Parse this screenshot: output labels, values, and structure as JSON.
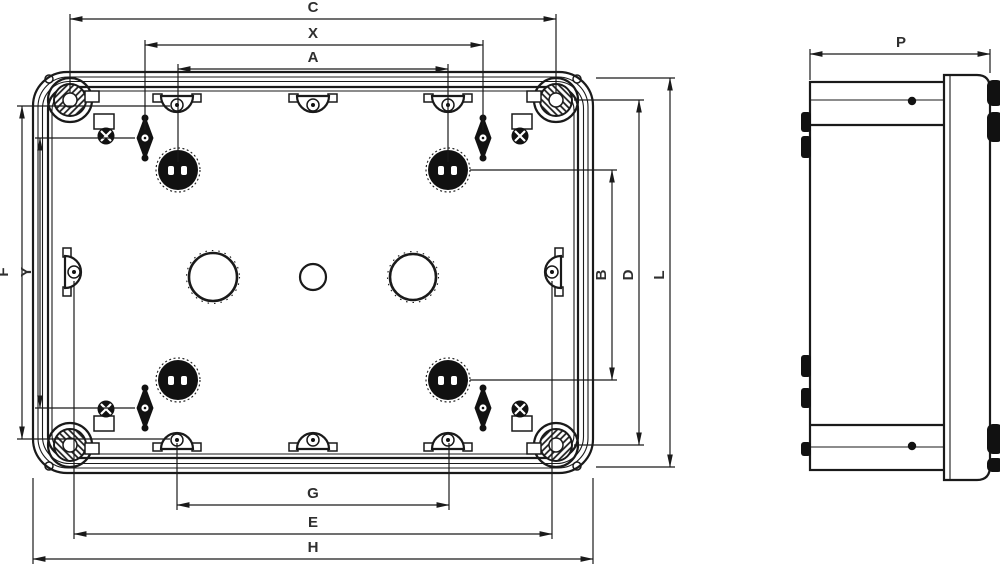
{
  "colors": {
    "line": "#1a1a1a",
    "label": "#2f2f2f",
    "background": "#ffffff"
  },
  "dimension_labels": {
    "plan_top": [
      "C",
      "X",
      "A"
    ],
    "plan_left": [
      "F",
      "Y"
    ],
    "plan_right": [
      "B",
      "D",
      "L"
    ],
    "plan_bottom": [
      "G",
      "E",
      "H"
    ],
    "side_top": [
      "P"
    ]
  }
}
